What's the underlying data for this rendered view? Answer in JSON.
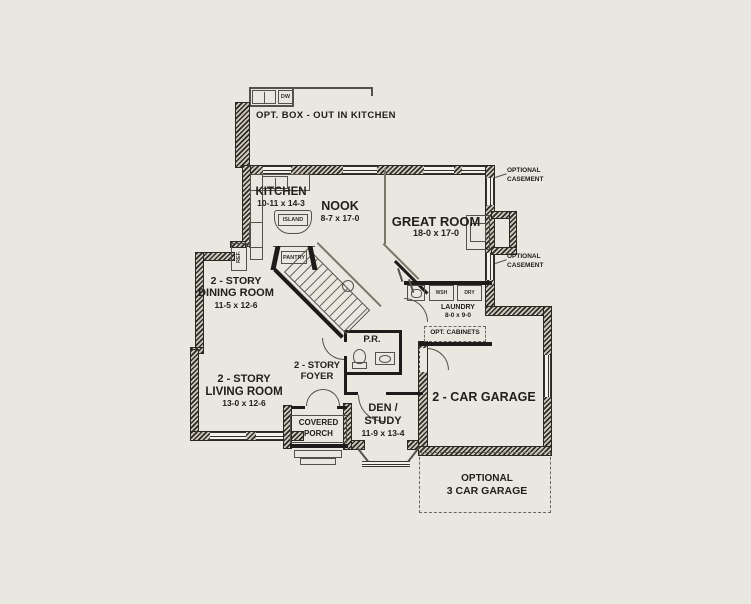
{
  "colors": {
    "background": "#eae7e0",
    "wall": "#2a2822",
    "line": "#55514a"
  },
  "annotations": {
    "opt_box": "OPT. BOX - OUT IN KITCHEN",
    "casement_l1": "OPTIONAL",
    "casement_l2": "CASEMENT",
    "opt_cabinets": "OPT. CABINETS"
  },
  "rooms": {
    "kitchen": {
      "name": "KITCHEN",
      "dims": "10-11 x 14-3"
    },
    "nook": {
      "name": "NOOK",
      "dims": "8-7 x 17-0"
    },
    "great_room": {
      "name": "GREAT ROOM",
      "dims": "18-0 x 17-0"
    },
    "dining": {
      "l1": "2 - STORY",
      "l2": "DINING ROOM",
      "dims": "11-5 x 12-6"
    },
    "living": {
      "l1": "2 - STORY",
      "l2": "LIVING ROOM",
      "dims": "13-0 x 12-6"
    },
    "foyer": {
      "l1": "2 - STORY",
      "l2": "FOYER"
    },
    "den": {
      "l1": "DEN /",
      "l2": "STUDY",
      "dims": "11-9 x 13-4"
    },
    "powder_room": {
      "name": "P.R."
    },
    "laundry": {
      "name": "LAUNDRY",
      "dims": "8-0 x 9-0"
    },
    "garage": {
      "name": "2 - CAR GARAGE"
    },
    "covered_porch": {
      "l1": "COVERED",
      "l2": "PORCH"
    },
    "optional_garage": {
      "l1": "OPTIONAL",
      "l2": "3 CAR GARAGE"
    },
    "pantry": {
      "name": "PANTRY"
    }
  },
  "fixtures": {
    "island": "ISLAND",
    "refrigerator": "REF.",
    "dishwasher": "DW",
    "washer": "WSH",
    "dryer": "DRY"
  }
}
